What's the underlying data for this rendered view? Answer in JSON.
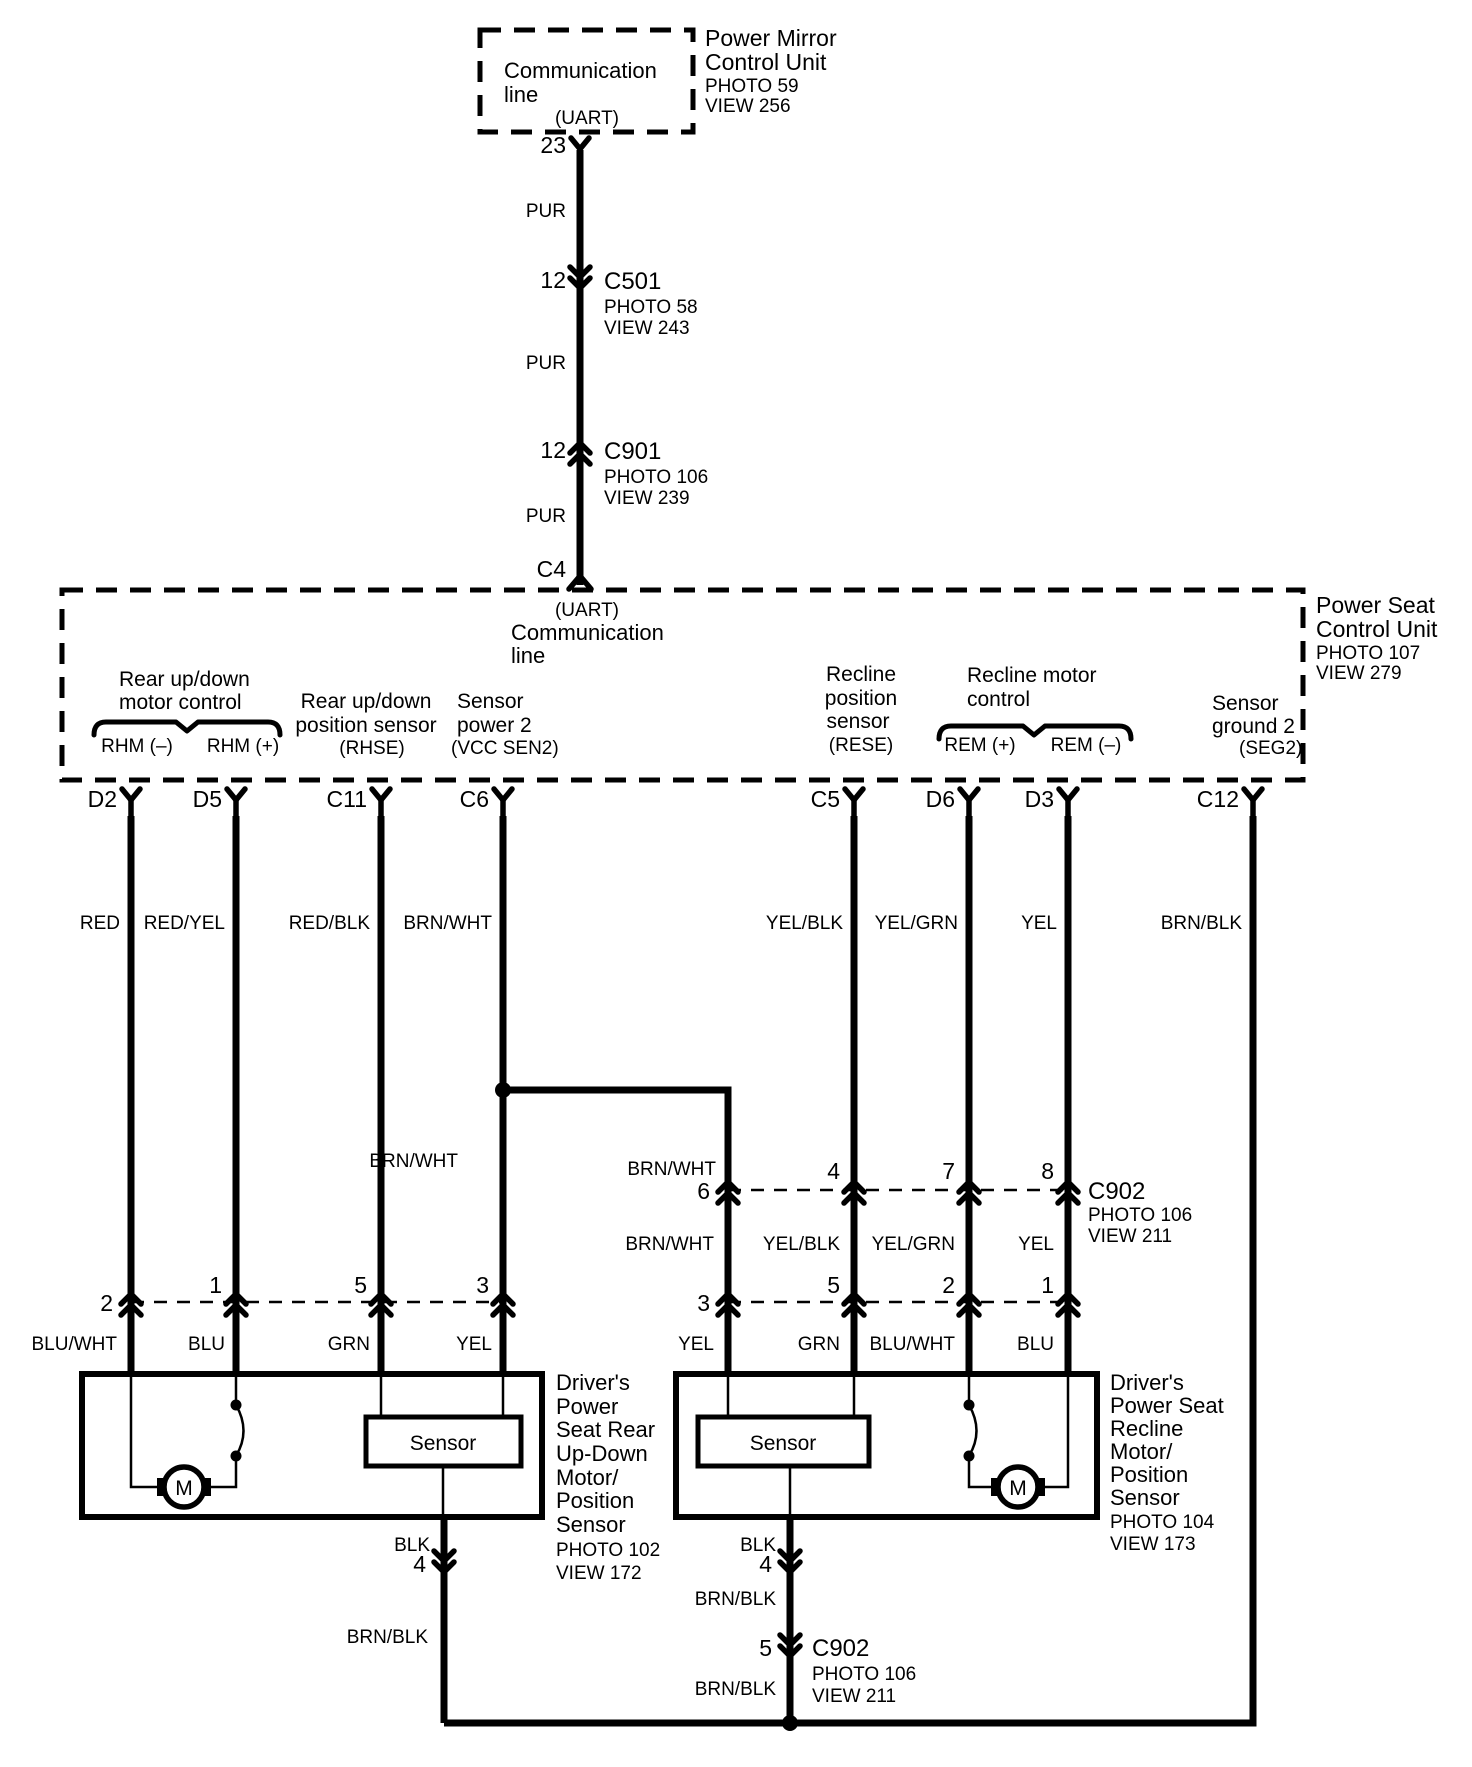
{
  "pm": {
    "box_line1": "Communication",
    "box_line2": "line",
    "uart": "(UART)",
    "title1": "Power Mirror",
    "title2": "Control Unit",
    "photo": "PHOTO 59",
    "view": "VIEW 256",
    "pin": "23"
  },
  "trunk": {
    "pur1": "PUR",
    "pur2": "PUR",
    "pur3": "PUR",
    "c501": {
      "pin": "12",
      "name": "C501",
      "photo": "PHOTO 58",
      "view": "VIEW 243"
    },
    "c901": {
      "pin": "12",
      "name": "C901",
      "photo": "PHOTO 106",
      "view": "VIEW 239"
    },
    "c4": "C4"
  },
  "ps": {
    "uart": "(UART)",
    "comm1": "Communication",
    "comm2": "line",
    "title1": "Power Seat",
    "title2": "Control Unit",
    "photo": "PHOTO 107",
    "view": "VIEW 279",
    "rear_motor1": "Rear up/down",
    "rear_motor2": "motor control",
    "rhm_minus": "RHM (–)",
    "rhm_plus": "RHM (+)",
    "rear_sensor1": "Rear up/down",
    "rear_sensor2": "position sensor",
    "rhse": "(RHSE)",
    "sensor_power1": "Sensor",
    "sensor_power2": "power 2",
    "vcc_sen2": "(VCC SEN2)",
    "recline_sensor1": "Recline",
    "recline_sensor2": "position",
    "recline_sensor3": "sensor",
    "rese": "(RESE)",
    "recline_motor1": "Recline motor",
    "recline_motor2": "control",
    "rem_plus": "REM (+)",
    "rem_minus": "REM (–)",
    "sensor_ground1": "Sensor",
    "sensor_ground2": "ground 2",
    "seg2": "(SEG2)",
    "pins": [
      "D2",
      "D5",
      "C11",
      "C6",
      "C5",
      "D6",
      "D3",
      "C12"
    ]
  },
  "wire_colors": [
    "RED",
    "RED/YEL",
    "RED/BLK",
    "BRN/WHT",
    "YEL/BLK",
    "YEL/GRN",
    "YEL",
    "BRN/BLK"
  ],
  "mid": {
    "branch_color": "BRN/WHT",
    "c6_color": "BRN/WHT",
    "pins": [
      "6",
      "4",
      "7",
      "8"
    ],
    "c902_name": "C902",
    "c902_photo": "PHOTO 106",
    "c902_view": "VIEW 211",
    "colors_below": [
      "BRN/WHT",
      "YEL/BLK",
      "YEL/GRN",
      "YEL"
    ]
  },
  "left_conn": {
    "pins": [
      "2",
      "1",
      "5",
      "3"
    ],
    "colors": [
      "BLU/WHT",
      "BLU",
      "GRN",
      "YEL"
    ]
  },
  "right_conn": {
    "pins": [
      "3",
      "5",
      "2",
      "1"
    ],
    "colors": [
      "YEL",
      "GRN",
      "BLU/WHT",
      "BLU"
    ]
  },
  "left_asm": {
    "sensor": "Sensor",
    "motor": "M",
    "title": [
      "Driver's",
      "Power",
      "Seat Rear",
      "Up-Down",
      "Motor/",
      "Position",
      "Sensor",
      "PHOTO 102",
      "VIEW 172"
    ],
    "blk": "BLK",
    "pin": "4",
    "brnblk": "BRN/BLK"
  },
  "right_asm": {
    "sensor": "Sensor",
    "motor": "M",
    "title": [
      "Driver's",
      "Power Seat",
      "Recline",
      "Motor/",
      "Position",
      "Sensor",
      "PHOTO 104",
      "VIEW 173"
    ],
    "blk": "BLK",
    "pin": "4",
    "brnblk1": "BRN/BLK",
    "c902_pin": "5",
    "c902_name": "C902",
    "c902_photo": "PHOTO 106",
    "c902_view": "VIEW 211",
    "brnblk2": "BRN/BLK"
  }
}
